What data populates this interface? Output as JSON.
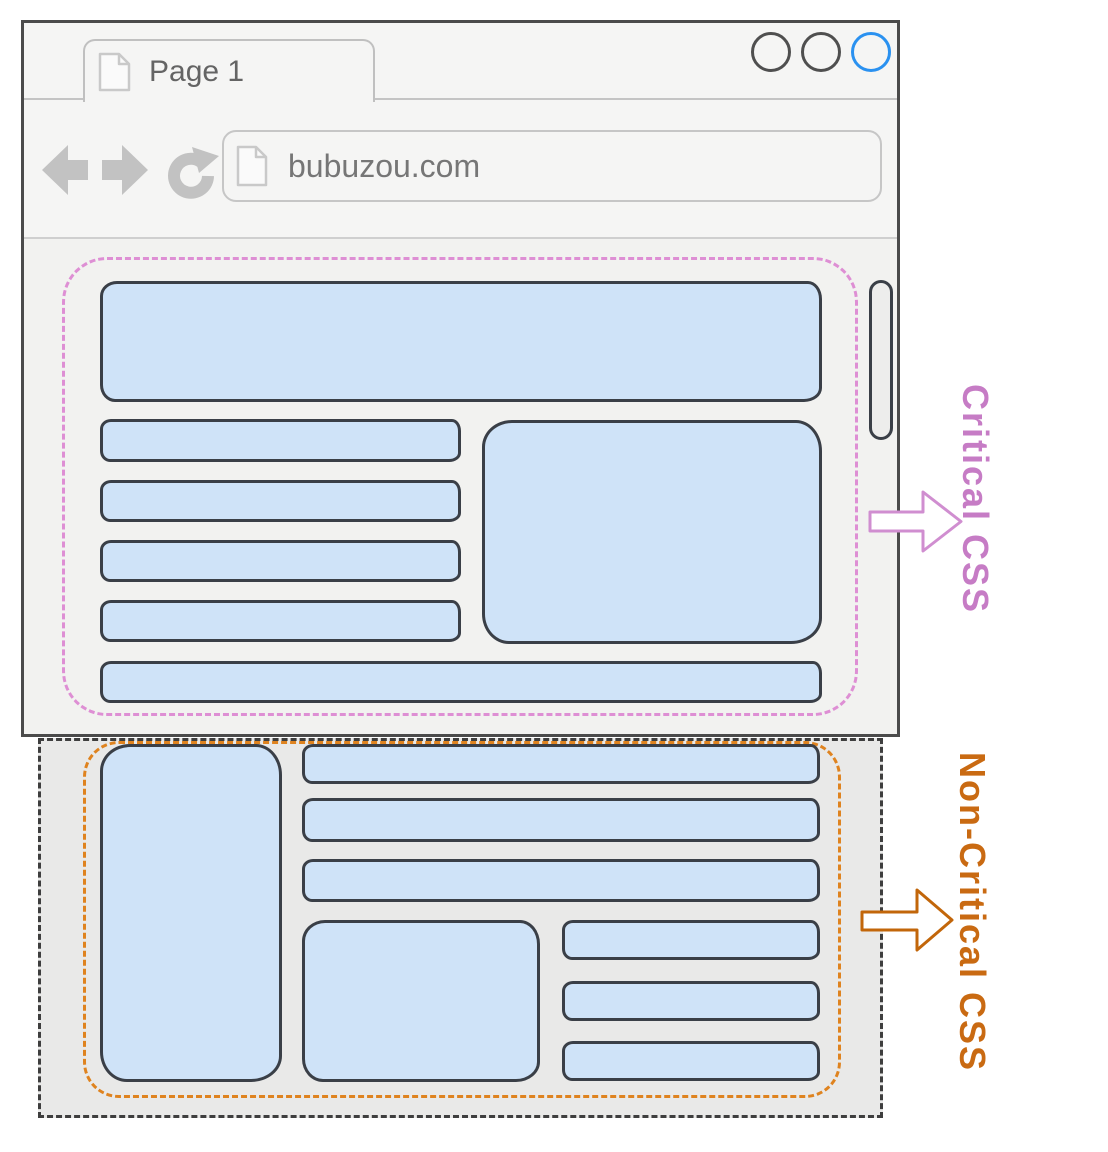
{
  "browser": {
    "tab_label": "Page 1",
    "url": "bubuzou.com",
    "window_controls": {
      "count": 3,
      "inactive_color": "#4f4f4f",
      "active_color": "#2a91f0"
    }
  },
  "annotations": {
    "critical_label": "Critical CSS",
    "non_critical_label": "Non-Critical CSS"
  },
  "colors": {
    "critical_accent": "#c67cc5",
    "critical_dash": "#de8fd4",
    "non_critical_accent": "#c96a12",
    "non_critical_dash": "#df831f",
    "below_fold_dash": "#3e3e3e",
    "block_fill": "#cfe3f8",
    "block_border": "#3a3f47",
    "chrome_gray": "#c4c4c4"
  }
}
